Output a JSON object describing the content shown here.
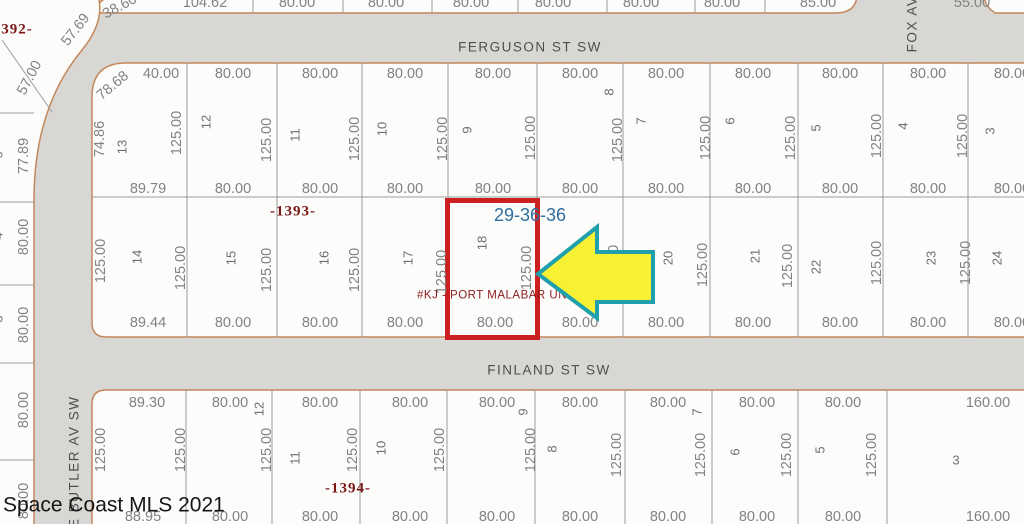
{
  "map": {
    "colors": {
      "street_fill": "#d8d7d4",
      "lot_fill": "#fcfcfa",
      "block_edge": "#c4875c",
      "lot_line": "#9b9b9b",
      "highlight_box": "#cc2020",
      "arrow_fill": "#f7f033",
      "arrow_stroke": "#1fa0ac"
    },
    "labels": [
      {
        "text": "38.60",
        "x": 120,
        "y": 7,
        "rot": -28
      },
      {
        "text": "104.62",
        "x": 205,
        "y": 3
      },
      {
        "text": "80.00",
        "x": 297,
        "y": 3
      },
      {
        "text": "80.00",
        "x": 386,
        "y": 3
      },
      {
        "text": "80.00",
        "x": 471,
        "y": 3
      },
      {
        "text": "80.00",
        "x": 553,
        "y": 3
      },
      {
        "text": "80.00",
        "x": 641,
        "y": 3
      },
      {
        "text": "80.00",
        "x": 722,
        "y": 3
      },
      {
        "text": "85.00",
        "x": 818,
        "y": 3
      },
      {
        "text": "55.00",
        "x": 972,
        "y": 3
      },
      {
        "text": "392-",
        "x": 17,
        "y": 30,
        "kind": "plat",
        "name": "plat-page-392"
      },
      {
        "text": "57.69",
        "x": 76,
        "y": 30,
        "rot": -52
      },
      {
        "text": "57.00",
        "x": 30,
        "y": 78,
        "rot": -62
      },
      {
        "text": "77.89",
        "x": 24,
        "y": 156,
        "rot": -90
      },
      {
        "text": "80.00",
        "x": 24,
        "y": 237,
        "rot": -90
      },
      {
        "text": "80.00",
        "x": 24,
        "y": 325,
        "rot": -90
      },
      {
        "text": "80.00",
        "x": 24,
        "y": 410,
        "rot": -90
      },
      {
        "text": "80.00",
        "x": 24,
        "y": 501,
        "rot": -90
      },
      {
        "text": "6",
        "x": -2,
        "y": 155,
        "rot": -90,
        "kind": "lot"
      },
      {
        "text": "4",
        "x": -2,
        "y": 236,
        "rot": -90,
        "kind": "lot"
      },
      {
        "text": "3",
        "x": -2,
        "y": 319,
        "rot": -90,
        "kind": "lot"
      },
      {
        "text": "40.00",
        "x": 161,
        "y": 74
      },
      {
        "text": "80.00",
        "x": 233,
        "y": 74
      },
      {
        "text": "80.00",
        "x": 320,
        "y": 74
      },
      {
        "text": "80.00",
        "x": 405,
        "y": 74
      },
      {
        "text": "80.00",
        "x": 493,
        "y": 74
      },
      {
        "text": "80.00",
        "x": 580,
        "y": 74
      },
      {
        "text": "80.00",
        "x": 666,
        "y": 74
      },
      {
        "text": "80.00",
        "x": 753,
        "y": 74
      },
      {
        "text": "80.00",
        "x": 840,
        "y": 74
      },
      {
        "text": "80.00",
        "x": 928,
        "y": 74
      },
      {
        "text": "80.00",
        "x": 1012,
        "y": 74
      },
      {
        "text": "78.68",
        "x": 113,
        "y": 86,
        "rot": -40
      },
      {
        "text": "74.86",
        "x": 100,
        "y": 139,
        "rot": -90
      },
      {
        "text": "13",
        "x": 122,
        "y": 147,
        "rot": -90,
        "kind": "lot"
      },
      {
        "text": "12",
        "x": 206,
        "y": 122,
        "rot": -90,
        "kind": "lot"
      },
      {
        "text": "11",
        "x": 295,
        "y": 135,
        "rot": -90,
        "kind": "lot"
      },
      {
        "text": "10",
        "x": 382,
        "y": 129,
        "rot": -90,
        "kind": "lot"
      },
      {
        "text": "9",
        "x": 467,
        "y": 130,
        "rot": -90,
        "kind": "lot"
      },
      {
        "text": "8",
        "x": 609,
        "y": 92,
        "rot": -90,
        "kind": "lot"
      },
      {
        "text": "7",
        "x": 641,
        "y": 121,
        "rot": -90,
        "kind": "lot"
      },
      {
        "text": "6",
        "x": 730,
        "y": 121,
        "rot": -90,
        "kind": "lot"
      },
      {
        "text": "5",
        "x": 816,
        "y": 128,
        "rot": -90,
        "kind": "lot"
      },
      {
        "text": "4",
        "x": 903,
        "y": 126,
        "rot": -90,
        "kind": "lot"
      },
      {
        "text": "3",
        "x": 990,
        "y": 131,
        "rot": -90,
        "kind": "lot"
      },
      {
        "text": "125.00",
        "x": 177,
        "y": 133,
        "rot": -90
      },
      {
        "text": "125.00",
        "x": 267,
        "y": 140,
        "rot": -90
      },
      {
        "text": "125.00",
        "x": 355,
        "y": 139,
        "rot": -90
      },
      {
        "text": "125.00",
        "x": 443,
        "y": 139,
        "rot": -90
      },
      {
        "text": "125.00",
        "x": 531,
        "y": 138,
        "rot": -90
      },
      {
        "text": "125.00",
        "x": 618,
        "y": 140,
        "rot": -90
      },
      {
        "text": "125.00",
        "x": 706,
        "y": 138,
        "rot": -90
      },
      {
        "text": "125.00",
        "x": 791,
        "y": 138,
        "rot": -90
      },
      {
        "text": "125.00",
        "x": 877,
        "y": 136,
        "rot": -90
      },
      {
        "text": "125.00",
        "x": 963,
        "y": 136,
        "rot": -90
      },
      {
        "text": "89.79",
        "x": 148,
        "y": 189
      },
      {
        "text": "80.00",
        "x": 233,
        "y": 189
      },
      {
        "text": "80.00",
        "x": 320,
        "y": 189
      },
      {
        "text": "80.00",
        "x": 405,
        "y": 189
      },
      {
        "text": "80.00",
        "x": 493,
        "y": 189
      },
      {
        "text": "80.00",
        "x": 580,
        "y": 189
      },
      {
        "text": "80.00",
        "x": 666,
        "y": 189
      },
      {
        "text": "80.00",
        "x": 753,
        "y": 189
      },
      {
        "text": "80.00",
        "x": 840,
        "y": 189
      },
      {
        "text": "80.00",
        "x": 928,
        "y": 189
      },
      {
        "text": "80.00",
        "x": 1012,
        "y": 189
      },
      {
        "text": "-1393-",
        "x": 293,
        "y": 212,
        "kind": "plat",
        "name": "plat-page-1393"
      },
      {
        "text": "29-36-36",
        "x": 530,
        "y": 215,
        "kind": "section",
        "name": "section-township-range"
      },
      {
        "text": "125.00",
        "x": 101,
        "y": 261,
        "rot": -90
      },
      {
        "text": "14",
        "x": 137,
        "y": 257,
        "rot": -90,
        "kind": "lot"
      },
      {
        "text": "15",
        "x": 231,
        "y": 258,
        "rot": -90,
        "kind": "lot"
      },
      {
        "text": "16",
        "x": 324,
        "y": 258,
        "rot": -90,
        "kind": "lot"
      },
      {
        "text": "17",
        "x": 408,
        "y": 258,
        "rot": -90,
        "kind": "lot"
      },
      {
        "text": "18",
        "x": 482,
        "y": 243,
        "rot": -90,
        "kind": "lot",
        "name": "highlighted-lot-number"
      },
      {
        "text": "20",
        "x": 668,
        "y": 258,
        "rot": -90,
        "kind": "lot"
      },
      {
        "text": "21",
        "x": 755,
        "y": 256,
        "rot": -90,
        "kind": "lot"
      },
      {
        "text": "22",
        "x": 816,
        "y": 267,
        "rot": -90,
        "kind": "lot"
      },
      {
        "text": "23",
        "x": 931,
        "y": 258,
        "rot": -90,
        "kind": "lot"
      },
      {
        "text": "24",
        "x": 997,
        "y": 258,
        "rot": -90,
        "kind": "lot"
      },
      {
        "text": "125.00",
        "x": 181,
        "y": 268,
        "rot": -90
      },
      {
        "text": "125.00",
        "x": 267,
        "y": 270,
        "rot": -90
      },
      {
        "text": "125.00",
        "x": 355,
        "y": 270,
        "rot": -90
      },
      {
        "text": "125.00",
        "x": 442,
        "y": 272,
        "rot": -90
      },
      {
        "text": "125.00",
        "x": 527,
        "y": 268,
        "rot": -90
      },
      {
        "text": "125.00",
        "x": 614,
        "y": 267,
        "rot": -90
      },
      {
        "text": "125.00",
        "x": 703,
        "y": 265,
        "rot": -90
      },
      {
        "text": "125.00",
        "x": 788,
        "y": 266,
        "rot": -90
      },
      {
        "text": "125.00",
        "x": 877,
        "y": 263,
        "rot": -90
      },
      {
        "text": "125.00",
        "x": 966,
        "y": 263,
        "rot": -90
      },
      {
        "text": "#KJ - PORT MALABAR UNIT",
        "x": 417,
        "y": 296,
        "kind": "legal",
        "anchor": "left",
        "name": "subdivision-legal-text"
      },
      {
        "text": "89.44",
        "x": 148,
        "y": 323
      },
      {
        "text": "80.00",
        "x": 233,
        "y": 323
      },
      {
        "text": "80.00",
        "x": 320,
        "y": 323
      },
      {
        "text": "80.00",
        "x": 405,
        "y": 323
      },
      {
        "text": "80.00",
        "x": 495,
        "y": 323
      },
      {
        "text": "80.00",
        "x": 580,
        "y": 323
      },
      {
        "text": "80.00",
        "x": 666,
        "y": 323
      },
      {
        "text": "80.00",
        "x": 753,
        "y": 323
      },
      {
        "text": "80.00",
        "x": 840,
        "y": 323
      },
      {
        "text": "80.00",
        "x": 928,
        "y": 323
      },
      {
        "text": "80.00",
        "x": 1012,
        "y": 323
      },
      {
        "text": "89.30",
        "x": 147,
        "y": 403
      },
      {
        "text": "80.00",
        "x": 230,
        "y": 403
      },
      {
        "text": "80.00",
        "x": 320,
        "y": 403
      },
      {
        "text": "80.00",
        "x": 410,
        "y": 403
      },
      {
        "text": "80.00",
        "x": 497,
        "y": 403
      },
      {
        "text": "80.00",
        "x": 580,
        "y": 403
      },
      {
        "text": "80.00",
        "x": 668,
        "y": 403
      },
      {
        "text": "80.00",
        "x": 757,
        "y": 403
      },
      {
        "text": "80.00",
        "x": 843,
        "y": 403
      },
      {
        "text": "160.00",
        "x": 988,
        "y": 403
      },
      {
        "text": "12",
        "x": 259,
        "y": 409,
        "rot": -90,
        "kind": "lot"
      },
      {
        "text": "11",
        "x": 295,
        "y": 458,
        "rot": -90,
        "kind": "lot"
      },
      {
        "text": "10",
        "x": 381,
        "y": 448,
        "rot": -90,
        "kind": "lot"
      },
      {
        "text": "9",
        "x": 523,
        "y": 412,
        "rot": -90,
        "kind": "lot"
      },
      {
        "text": "8",
        "x": 552,
        "y": 449,
        "rot": -90,
        "kind": "lot"
      },
      {
        "text": "7",
        "x": 697,
        "y": 412,
        "rot": -90,
        "kind": "lot"
      },
      {
        "text": "6",
        "x": 735,
        "y": 452,
        "rot": -90,
        "kind": "lot"
      },
      {
        "text": "5",
        "x": 820,
        "y": 450,
        "rot": -90,
        "kind": "lot"
      },
      {
        "text": "3",
        "x": 956,
        "y": 460,
        "kind": "lot"
      },
      {
        "text": "125.00",
        "x": 101,
        "y": 450,
        "rot": -90
      },
      {
        "text": "125.00",
        "x": 181,
        "y": 450,
        "rot": -90
      },
      {
        "text": "125.00",
        "x": 267,
        "y": 450,
        "rot": -90
      },
      {
        "text": "125.00",
        "x": 353,
        "y": 450,
        "rot": -90
      },
      {
        "text": "125.00",
        "x": 440,
        "y": 450,
        "rot": -90
      },
      {
        "text": "125.00",
        "x": 531,
        "y": 450,
        "rot": -90
      },
      {
        "text": "125.00",
        "x": 617,
        "y": 455,
        "rot": -90
      },
      {
        "text": "125.00",
        "x": 701,
        "y": 455,
        "rot": -90
      },
      {
        "text": "125.00",
        "x": 787,
        "y": 455,
        "rot": -90
      },
      {
        "text": "125.00",
        "x": 872,
        "y": 455,
        "rot": -90
      },
      {
        "text": "-1394-",
        "x": 348,
        "y": 489,
        "kind": "plat",
        "name": "plat-page-1394"
      },
      {
        "text": "88.95",
        "x": 143,
        "y": 517
      },
      {
        "text": "80.00",
        "x": 230,
        "y": 517
      },
      {
        "text": "80.00",
        "x": 320,
        "y": 517
      },
      {
        "text": "80.00",
        "x": 410,
        "y": 517
      },
      {
        "text": "80.00",
        "x": 497,
        "y": 517
      },
      {
        "text": "80.00",
        "x": 580,
        "y": 517
      },
      {
        "text": "80.00",
        "x": 668,
        "y": 517
      },
      {
        "text": "80.00",
        "x": 757,
        "y": 517
      },
      {
        "text": "80.00",
        "x": 843,
        "y": 517
      },
      {
        "text": "160.00",
        "x": 988,
        "y": 517
      },
      {
        "text": "FERGUSON ST SW",
        "x": 530,
        "y": 47,
        "kind": "street",
        "name": "street-name-ferguson"
      },
      {
        "text": "FINLAND ST SW",
        "x": 549,
        "y": 370,
        "kind": "street",
        "name": "street-name-finland"
      },
      {
        "text": "FOX AV",
        "x": 912,
        "y": 24,
        "rot": -90,
        "kind": "street",
        "name": "street-name-fox"
      },
      {
        "text": "KE BUTLER AV SW",
        "x": 74,
        "y": 467,
        "rot": -90,
        "kind": "street",
        "name": "street-name-lake-butler"
      },
      {
        "text": "Space Coast MLS 2021",
        "x": 3,
        "y": 505,
        "kind": "watermark",
        "anchor": "left",
        "name": "watermark"
      }
    ]
  }
}
